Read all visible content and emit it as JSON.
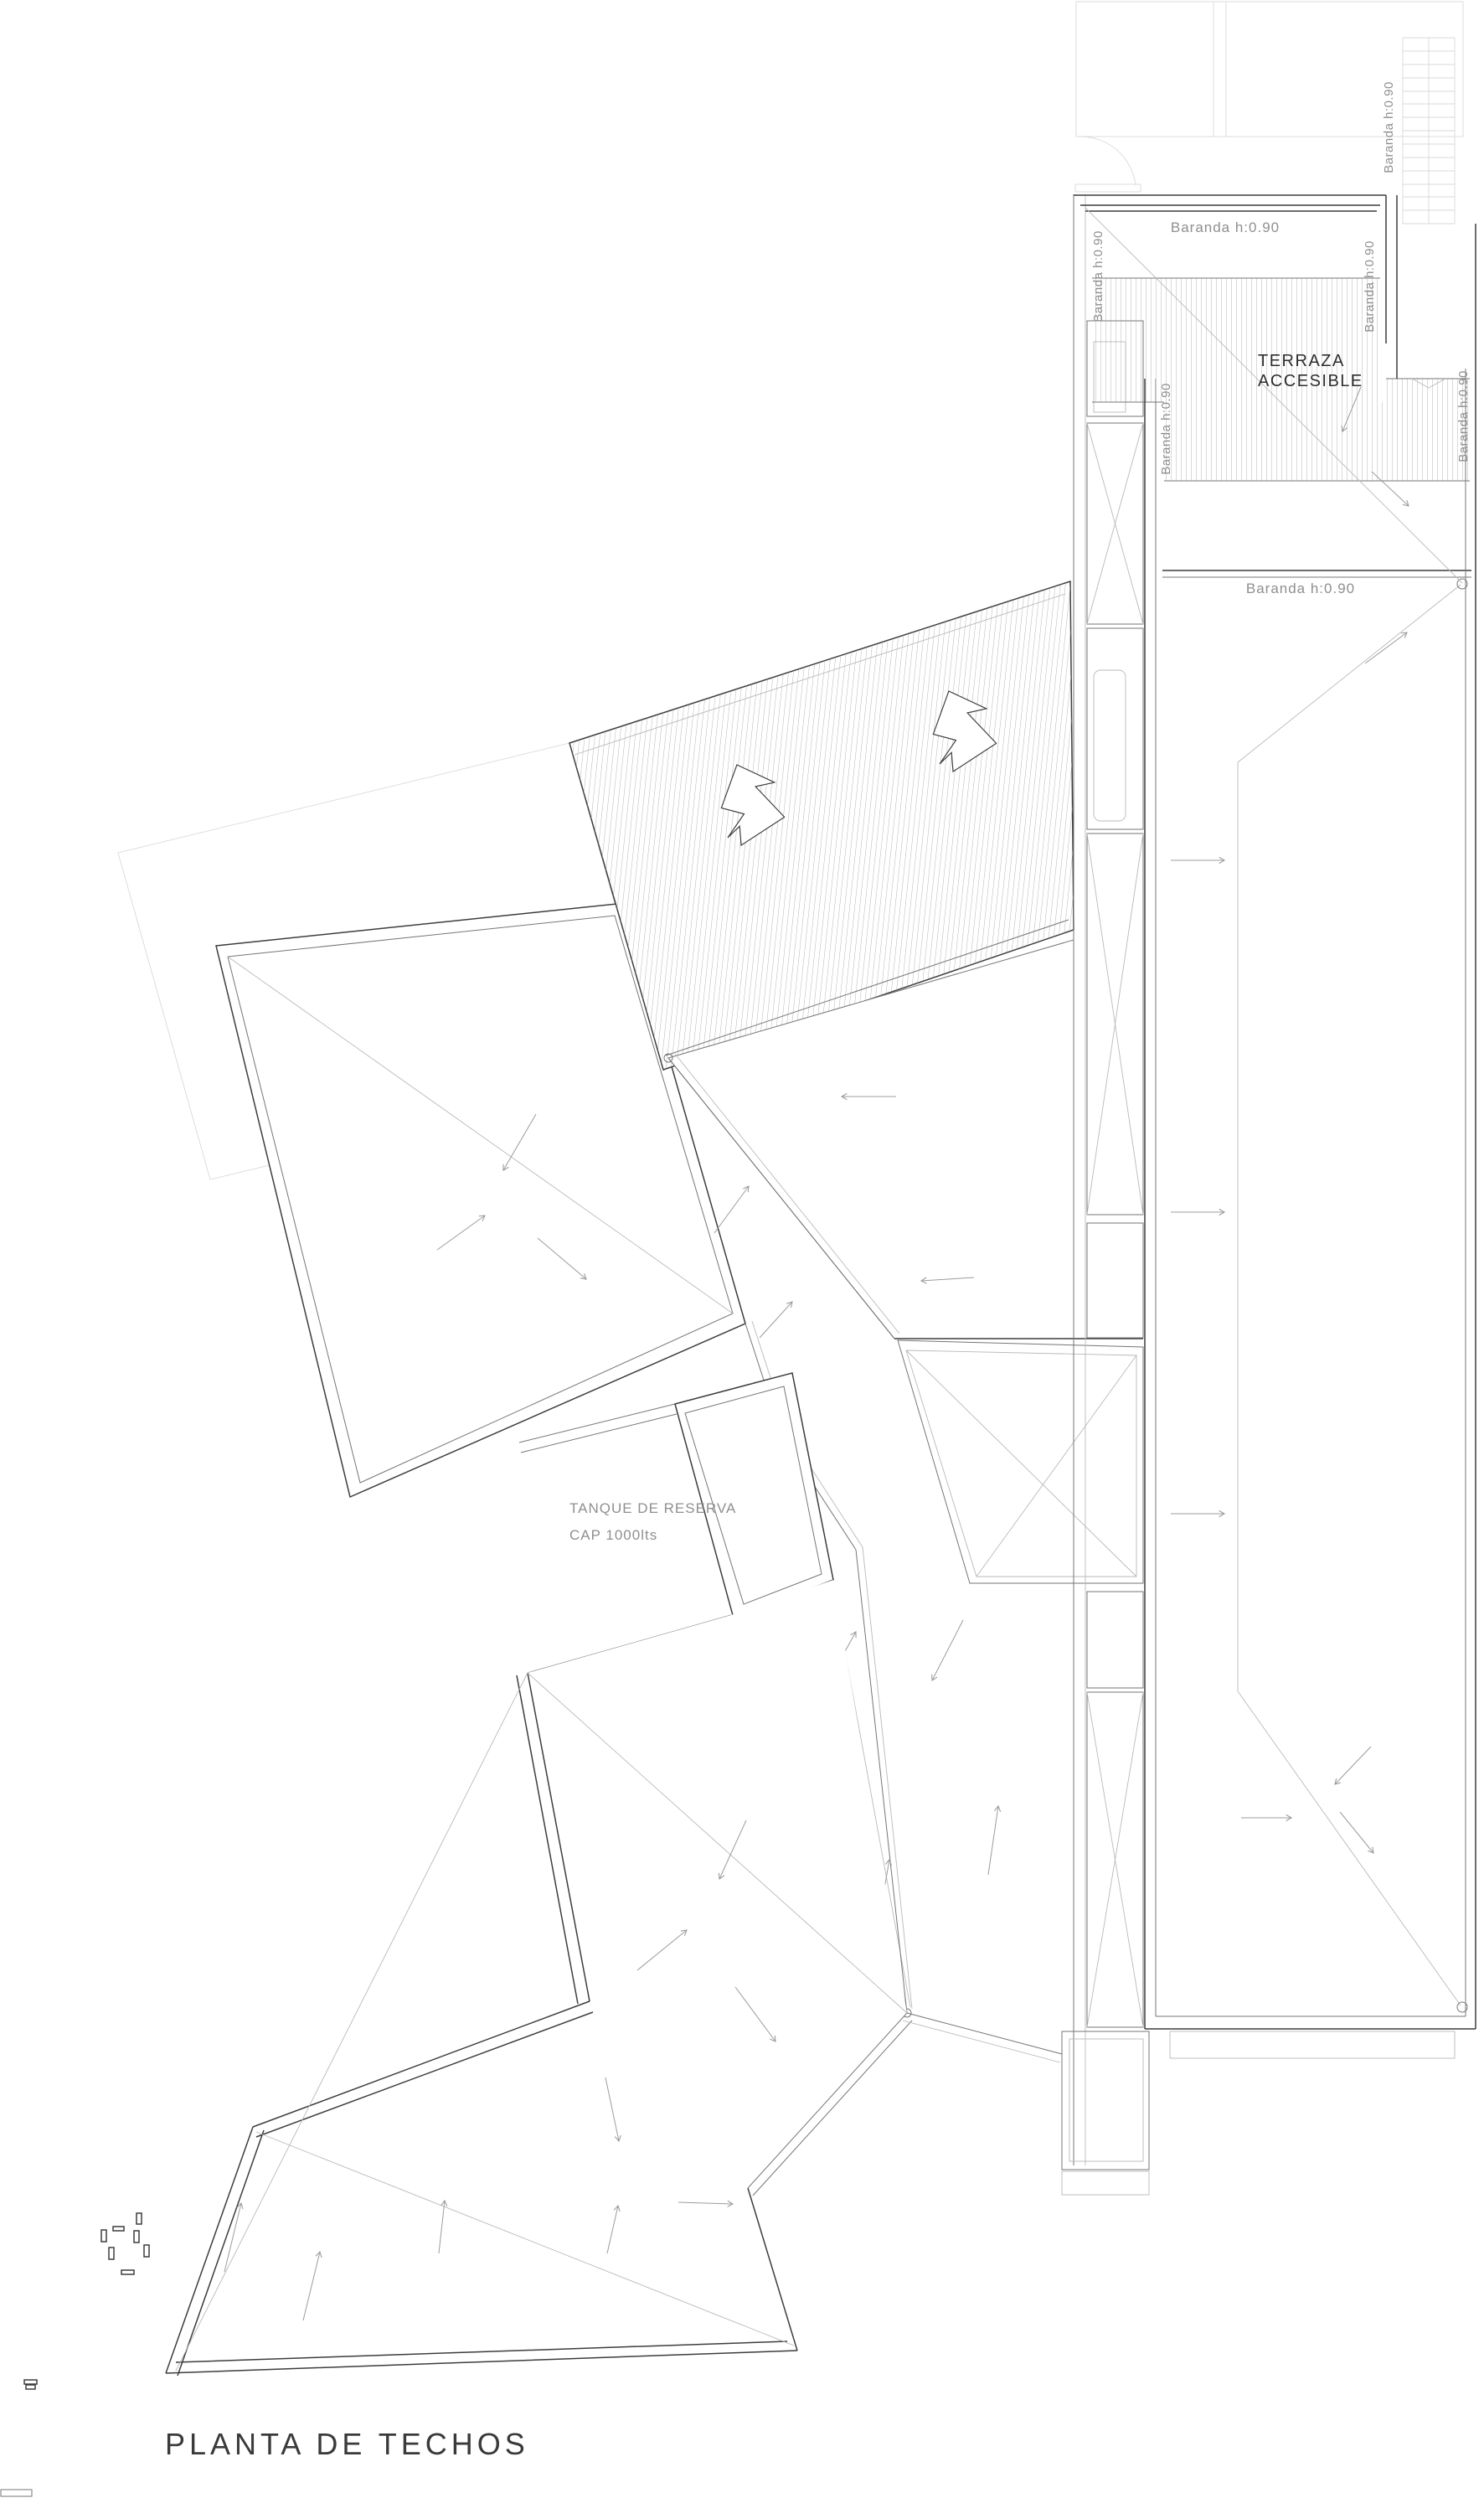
{
  "title": "PLANTA DE TECHOS",
  "labels": {
    "baranda": "Baranda  h:0.90",
    "terrace": {
      "line1": "TERRAZA",
      "line2": "ACCESIBLE"
    },
    "tank": {
      "line1": "TANQUE DE RESERVA",
      "line2": "CAP  1000lts"
    }
  },
  "colors": {
    "wall": "#3d3d3d",
    "medium": "#767676",
    "thin": "#b9b9b9",
    "faint": "#d9d9d9",
    "hatch": "#a3a3a3",
    "arrow": "#9c9c9c",
    "textDark": "#2e2e2e",
    "textGray": "#8f8f8f",
    "bg": "#ffffff"
  }
}
